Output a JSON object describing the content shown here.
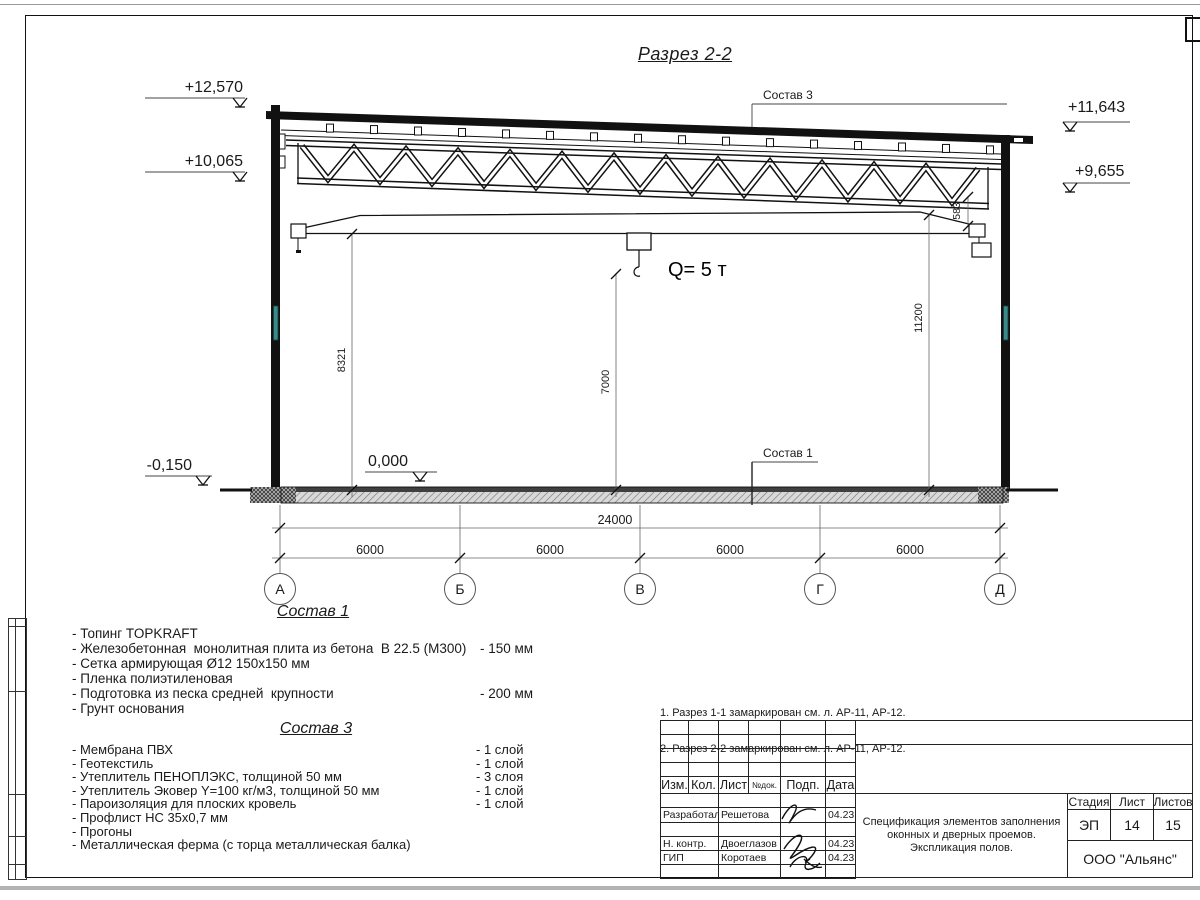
{
  "section": {
    "title": "Разрез 2-2",
    "crane_capacity": "Q= 5 т",
    "elevation_marks": {
      "left_top": "+12,570",
      "left_mid": "+10,065",
      "left_bottom": "-0,150",
      "floor": "0,000",
      "right_top": "+11,643",
      "right_mid": "+9,655"
    },
    "vertical_dims": {
      "left": "8321",
      "center": "7000",
      "right": "11200",
      "beam": "583"
    },
    "overall_dim": "24000",
    "span_dims": [
      "6000",
      "6000",
      "6000",
      "6000"
    ],
    "axes": [
      "А",
      "Б",
      "В",
      "Г",
      "Д"
    ],
    "leader_sostav1": "Состав 1",
    "leader_sostav3": "Состав 3"
  },
  "sostav1": {
    "heading": "Состав 1",
    "items": [
      {
        "text": "- Топинг TOPKRAFT",
        "value": ""
      },
      {
        "text": "- Железобетонная  монолитная плита из бетона  В 22.5 (М300)",
        "value": "- 150 мм"
      },
      {
        "text": "- Сетка армирующая Ø12 150х150 мм",
        "value": ""
      },
      {
        "text": "- Пленка полиэтиленовая",
        "value": ""
      },
      {
        "text": "- Подготовка из песка средней  крупности",
        "value": "- 200 мм"
      },
      {
        "text": "- Грунт основания",
        "value": ""
      }
    ]
  },
  "sostav3": {
    "heading": "Состав 3",
    "items": [
      {
        "text": "- Мембрана ПВХ",
        "value": "- 1 слой"
      },
      {
        "text": "- Геотекстиль",
        "value": "- 1 слой"
      },
      {
        "text": "- Утеплитель ПЕНОПЛЭКС, толщиной 50 мм",
        "value": "- 3 слоя"
      },
      {
        "text": "- Утеплитель Эковер Y=100 кг/м3, толщиной 50 мм",
        "value": "- 1 слой"
      },
      {
        "text": "- Пароизоляция для плоских кровель",
        "value": "- 1 слой"
      },
      {
        "text": "- Профлист НС 35х0,7 мм",
        "value": ""
      },
      {
        "text": "- Прогоны",
        "value": ""
      },
      {
        "text": "- Металлическая ферма (с торца металлическая балка)",
        "value": ""
      }
    ]
  },
  "notes": {
    "line1": "1. Разрез 1-1 замаркирован см. л. АР-11, АР-12.",
    "line2": "2. Разрез 2-2 замаркирован см. л. АР-11, АР-12."
  },
  "titleblock": {
    "col_izm": "Изм.",
    "col_kol": "Кол.",
    "col_list": "Лист",
    "col_ndok": "№док.",
    "col_podp": "Подп.",
    "col_data": "Дата",
    "row_developed_role": "Разработал",
    "row_developed_name": "Решетова",
    "row_developed_date": "04.23",
    "row_ncontr_role": "Н. контр.",
    "row_ncontr_name": "Двоеглазов",
    "row_ncontr_date": "04.23",
    "row_gip_role": "ГИП",
    "row_gip_name": "Коротаев",
    "row_gip_date": "04.23",
    "stage_label": "Стадия",
    "sheet_label": "Лист",
    "sheets_label": "Листов",
    "stage_value": "ЭП",
    "sheet_value": "14",
    "sheets_value": "15",
    "doc_title_line1": "Спецификация элементов заполнения",
    "doc_title_line2": "оконных и дверных проемов.",
    "doc_title_line3": "Экспликация полов.",
    "company": "ООО \"Альянс\""
  }
}
